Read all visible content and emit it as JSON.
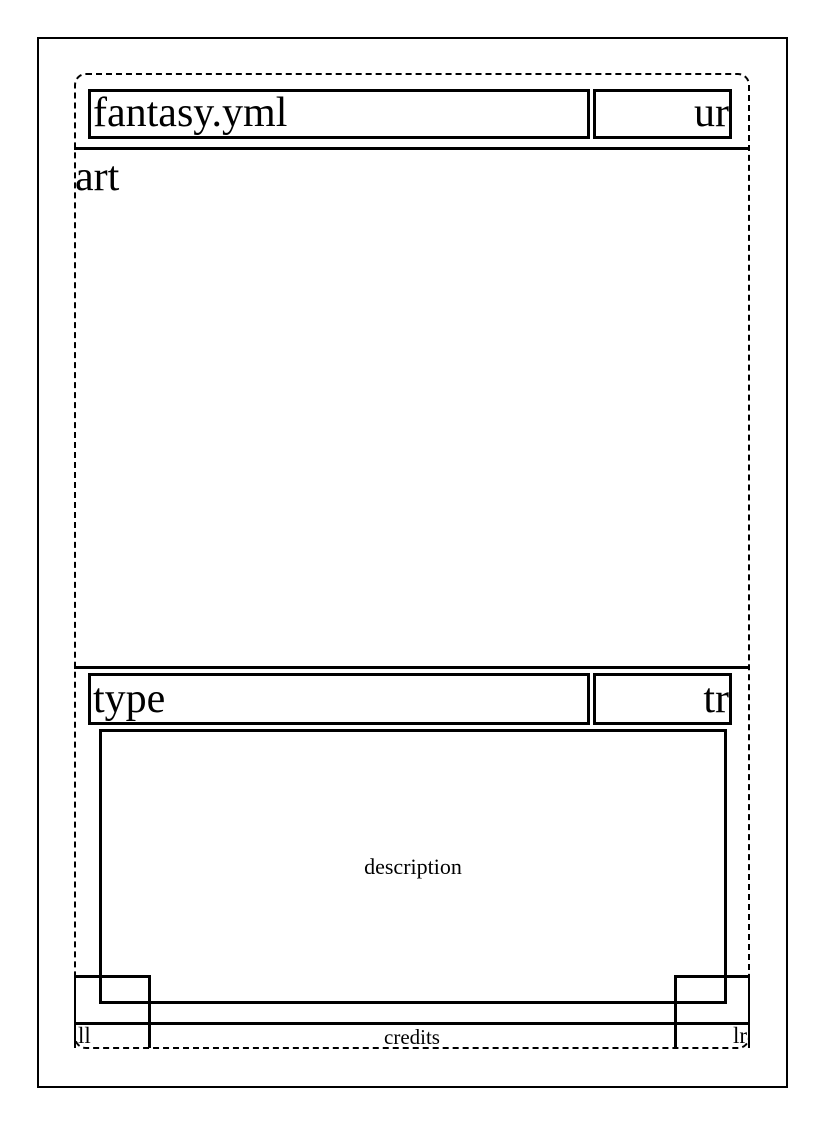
{
  "palette": {
    "ink": "#000000",
    "paper": "#ffffff"
  },
  "layout": {
    "file_label": "fantasy.yml",
    "zones": {
      "title": "fantasy.yml",
      "upper_right": "ur",
      "art": "art",
      "type": "type",
      "type_right": "tr",
      "description": "description",
      "lower_left": "ll",
      "credits": "credits",
      "lower_right": "lr"
    }
  }
}
